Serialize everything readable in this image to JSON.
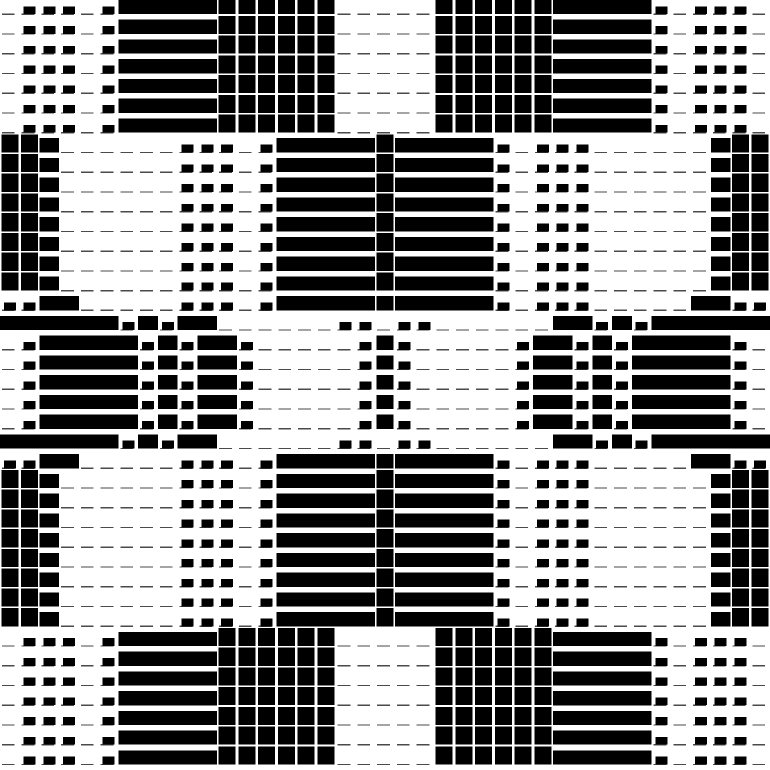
{
  "artwork": {
    "title": "monochrome-op-art-weave-pattern",
    "background_color": "#ffffff",
    "ink_color": "#000000",
    "hairline_color": "#4a4a4a",
    "canvas_size": 770,
    "grid_count": 39,
    "center_index": 19,
    "baseline_fraction": 0.72,
    "hairline_thickness": 1.25,
    "dash_inset_left": 2,
    "dash_shorten": 7,
    "symmetry": "mirrored about horizontal and vertical center axes",
    "classes": {
      "F": {
        "coverage": 0.92,
        "width": 17.0
      },
      "B": {
        "coverage": 0.72,
        "width": 19.75
      },
      "S": {
        "coverage": 0.4,
        "width": 12.0
      },
      "D": {
        "coverage": 0.0,
        "width": 0.0
      }
    },
    "row_patterns": {
      "A": "DSSSDSBBBBBFFFFFFDDD",
      "B": "FFBDDDDDDSSSDSBBBBBF",
      "C": "SSBBDDDDDSSSDSBBBBBF",
      "D": "BBBBBBSBSBBDDDDDDSSD",
      "E": "DSBBBBBSBSBBSDDDDDSF"
    },
    "row_sequence_top_half": [
      "A",
      "A",
      "A",
      "A",
      "A",
      "A",
      "A",
      "B",
      "B",
      "B",
      "B",
      "B",
      "B",
      "B",
      "B",
      "C",
      "D",
      "E",
      "E",
      "E"
    ],
    "row_coverage_top_half": [
      0.92,
      0.92,
      0.92,
      0.92,
      0.92,
      0.92,
      0.92,
      0.92,
      0.92,
      0.92,
      0.92,
      0.92,
      0.92,
      0.92,
      0.92,
      0.72,
      0.72,
      0.72,
      0.72,
      0.72
    ]
  }
}
